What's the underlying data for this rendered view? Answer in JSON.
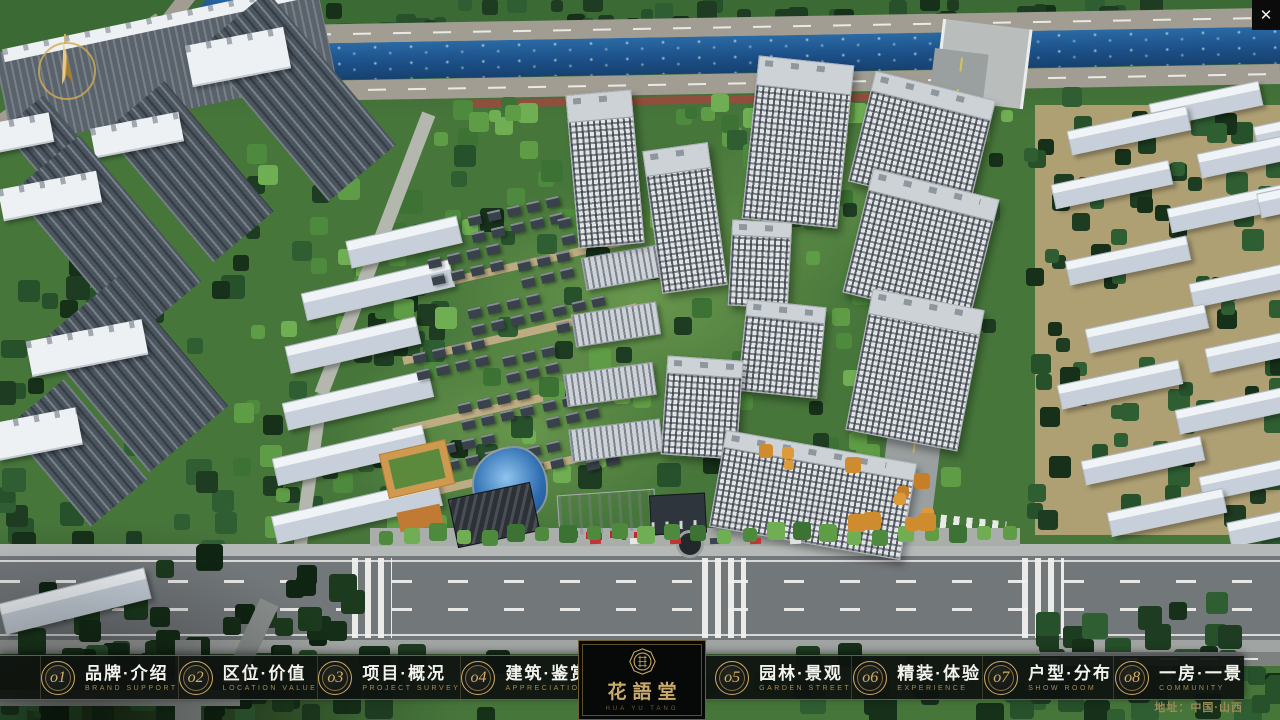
{
  "window": {
    "close_glyph": "✕"
  },
  "nav": {
    "items": [
      {
        "num": "o1",
        "cn": "品牌·介绍",
        "en": "BRAND SUPPORT"
      },
      {
        "num": "o2",
        "cn": "区位·价值",
        "en": "LOCATION VALUE"
      },
      {
        "num": "o3",
        "cn": "项目·概况",
        "en": "PROJECT SURVEY"
      },
      {
        "num": "o4",
        "cn": "建筑·鉴赏",
        "en": "APPRECIATION"
      },
      {
        "num": "o5",
        "cn": "园林·景观",
        "en": "GARDEN STREET"
      },
      {
        "num": "o6",
        "cn": "精装·体验",
        "en": "EXPERIENCE"
      },
      {
        "num": "o7",
        "cn": "户型·分布",
        "en": "SHOW ROOM"
      },
      {
        "num": "o8",
        "cn": "一房·一景",
        "en": "COMMUNITY"
      }
    ]
  },
  "logo": {
    "title": "花語堂",
    "caption": "HUA YU TANG"
  },
  "footer": {
    "address": "地址：中国·山西"
  },
  "colors": {
    "gold": "#b99c60",
    "gold_dim": "#a8894e",
    "bar_bg": "#10140f",
    "text_light": "#f3f2ec",
    "address": "#9d8a58",
    "river": "#1c5088",
    "accent_red": "#c4272e"
  }
}
